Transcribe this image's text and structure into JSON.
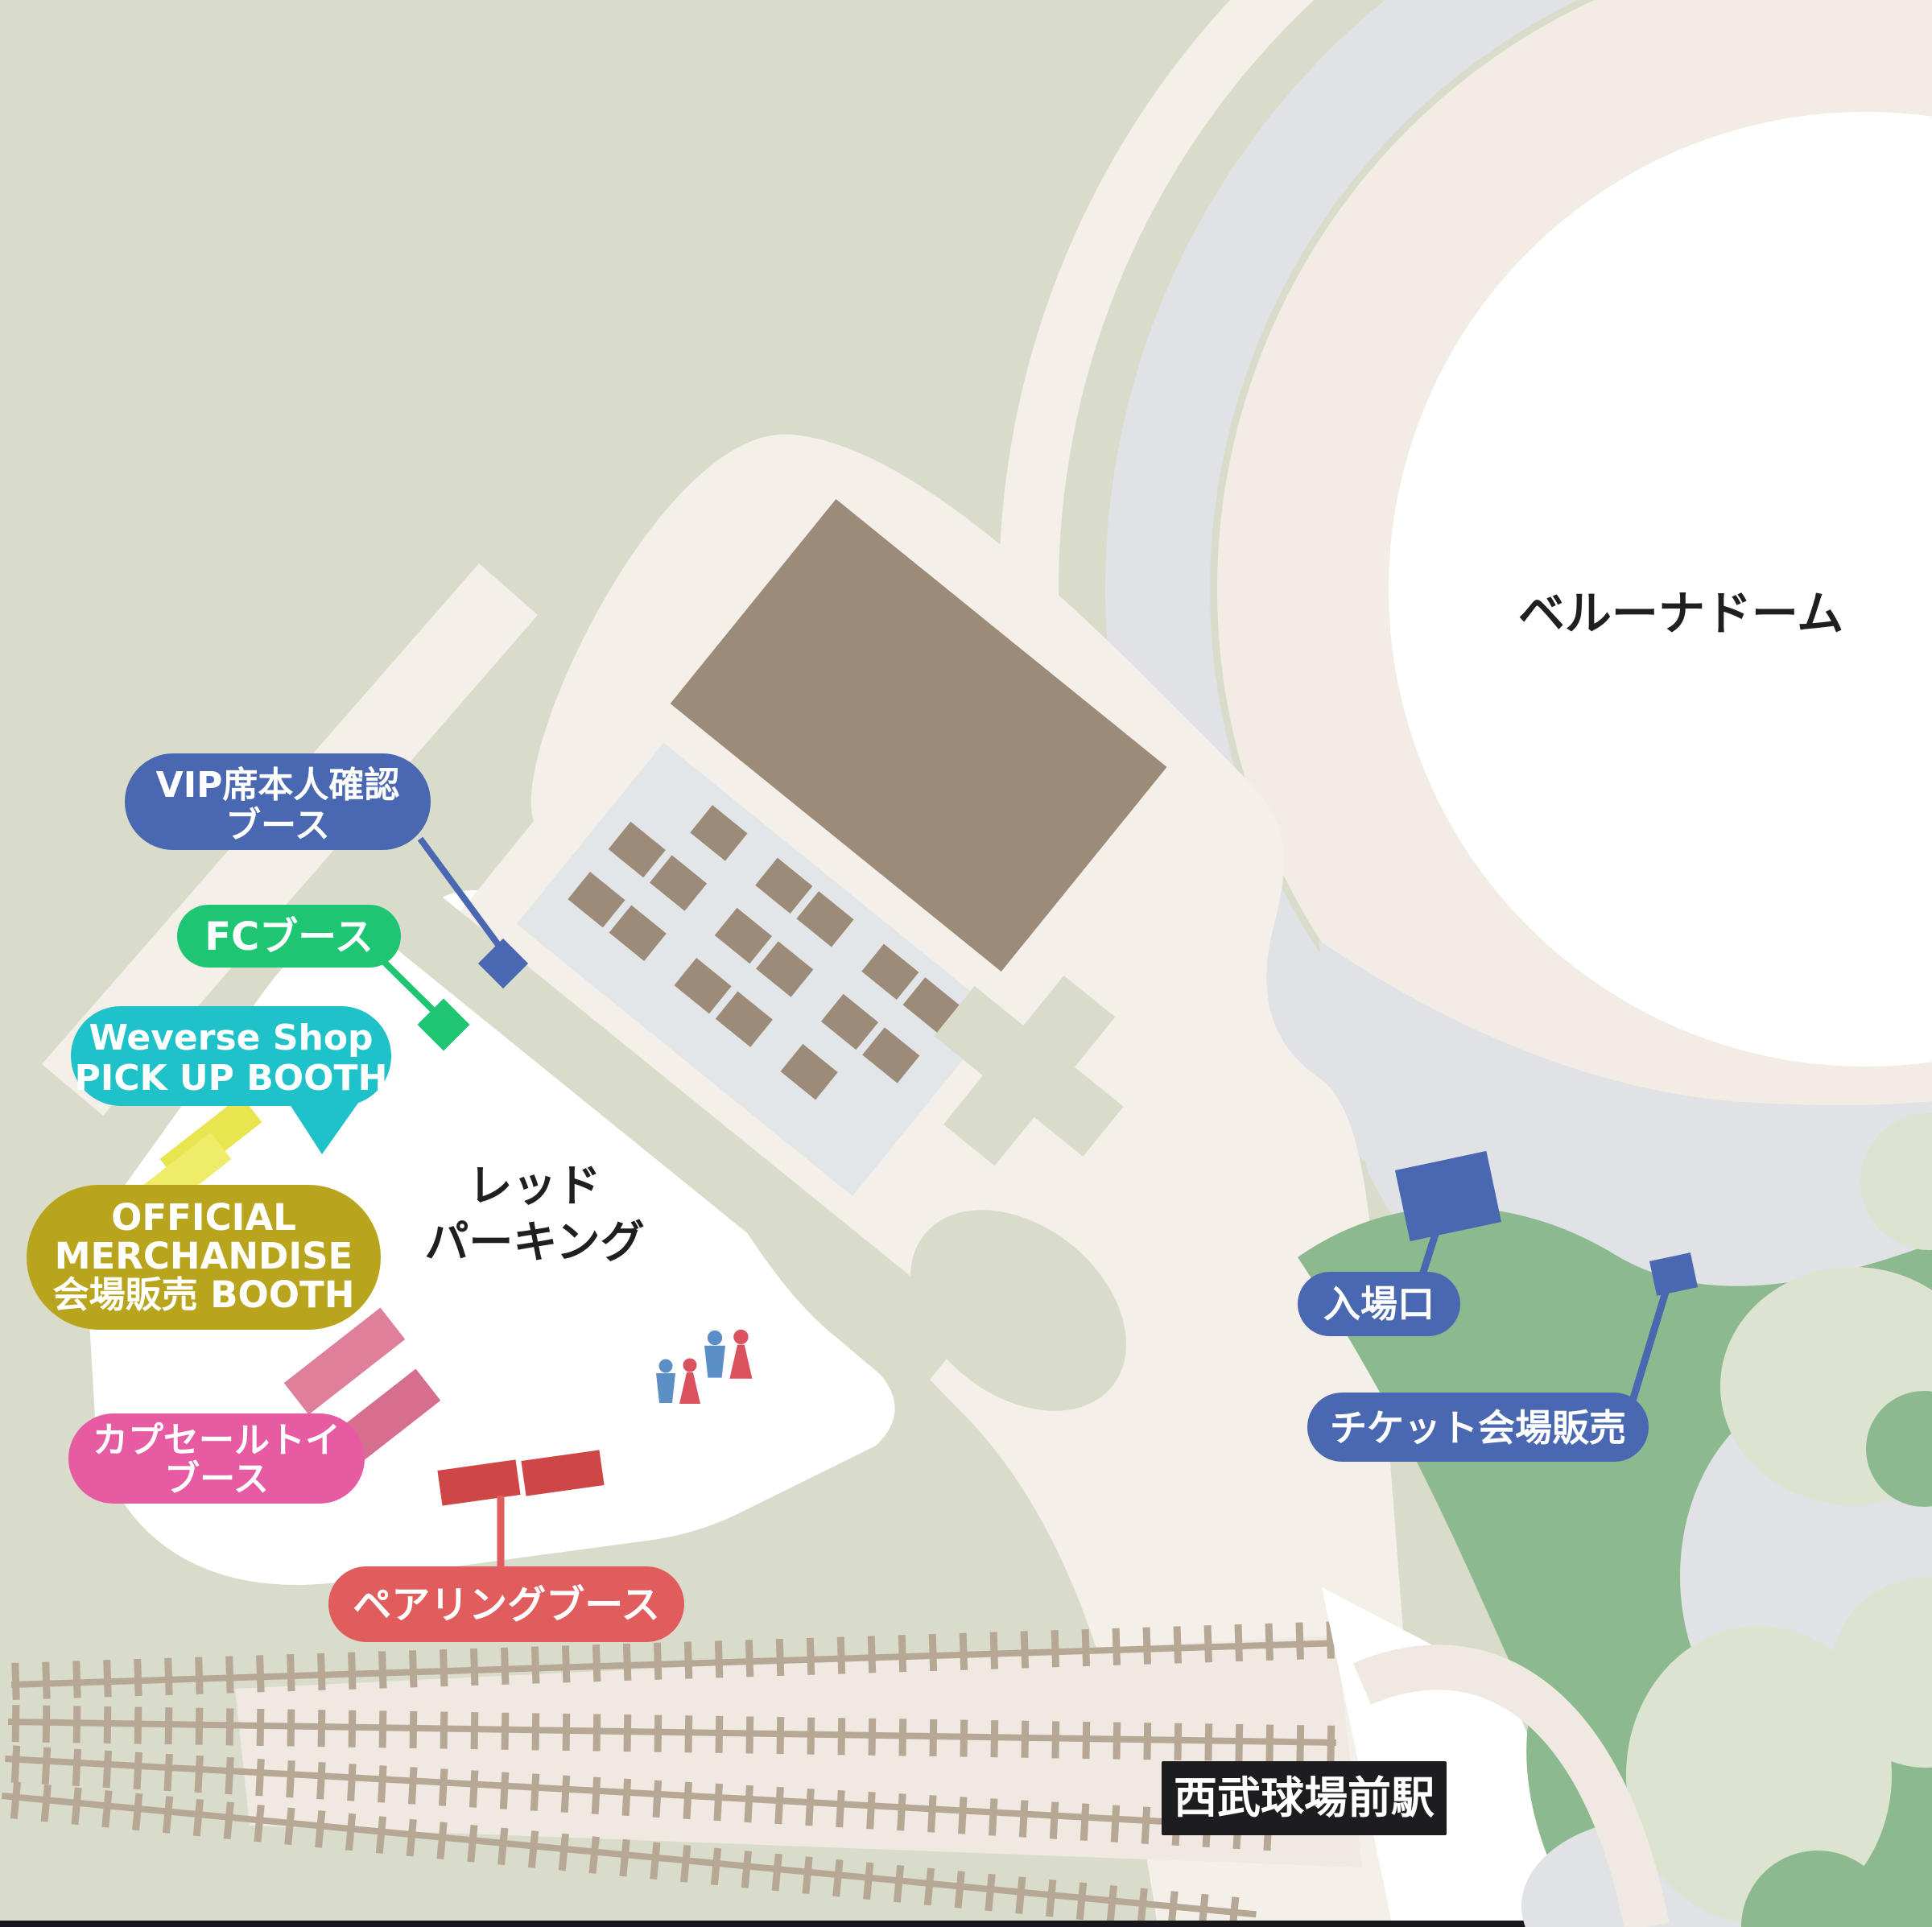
{
  "map_title": "ベルーナドーム",
  "landmarks": {
    "dome": "ベルーナドーム",
    "parking_line1": "レッド",
    "parking_line2": "パーキング",
    "station": "西武球場前駅"
  },
  "booth_labels": {
    "vip": {
      "line1": "VIP席本人確認",
      "line2": "ブース"
    },
    "fc": {
      "label": "FCブース"
    },
    "weverse": {
      "line1": "Weverse Shop",
      "line2": "PICK UP BOOTH"
    },
    "merch": {
      "line1": "OFFICIAL",
      "line2": "MERCHANDISE",
      "line3": "会場販売 BOOTH"
    },
    "capsule": {
      "line1": "カプセールトイ",
      "line2": "ブース"
    },
    "pairing": {
      "label": "ペアリングブース"
    },
    "entrance": {
      "label": "入場口"
    },
    "ticket": {
      "label": "チケット会場販売"
    }
  },
  "colors": {
    "background": "#d9dccb",
    "road": "#f5efe9",
    "station_band": "#efe9e2",
    "dome_plaza_gray": "#e0e2e5",
    "dome_ring_beige": "#f3ece5",
    "dome_white": "#ffffff",
    "building_brown": "#9c8b79",
    "parking_lot_gray": "#e3e6e9",
    "trees_green": "#8cba8e",
    "light_sage": "#dde3d1",
    "track_tan": "#b7a795",
    "label_blue": "#4a67b1",
    "label_green": "#1ec673",
    "label_teal": "#1fc2c8",
    "label_olive": "#b8a51d",
    "label_pink": "#e75ba2",
    "label_red": "#e15c5c",
    "booth_yellow": "#e9e54e",
    "booth_yellow_light": "#efec6a",
    "booth_pink": "#df7f9a",
    "booth_pink_dark": "#d66e8d",
    "booth_red": "#ce4646",
    "station_label_bg": "#1d1d20",
    "icon_male_blue": "#5d8fc7",
    "icon_female_red": "#d9525e",
    "text_black": "#1f1f22"
  }
}
